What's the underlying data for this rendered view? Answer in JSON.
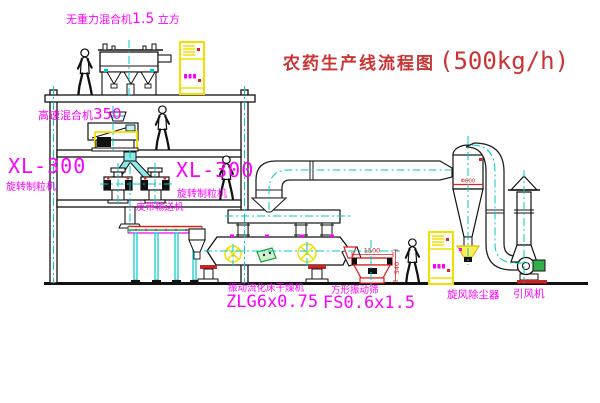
{
  "title": {
    "text": "农药生产线流程图",
    "capacity": "(500kg/h)"
  },
  "labels": {
    "gravity_mixer": {
      "name": "无重力混合机",
      "value": "1.5",
      "unit": "立方"
    },
    "high_speed_mixer": {
      "name": "高速混合机",
      "value": "350"
    },
    "granulator_left": {
      "model": "XL-300",
      "name": "旋转制粒机"
    },
    "granulator_right": {
      "model": "XL-300",
      "name": "旋转制粒机"
    },
    "belt_conveyor": "皮带输送机",
    "fluid_bed_dryer": {
      "name": "振动流化床干燥机",
      "model": "ZLG6x0.75"
    },
    "vibrating_screen": {
      "name": "方形振动筛",
      "model": "FS0.6x1.5"
    },
    "cyclone": "旋风除尘器",
    "induced_draft_fan": "引风机"
  },
  "dimensions": {
    "screen_length": "1500",
    "screen_height": "540",
    "cyclone_note": "Φ600"
  },
  "colors": {
    "label": "#ff00ff",
    "title": "#cc3333",
    "line": "#1a1a1a",
    "centerline": "#00c8c8",
    "highlight": "#f0e000",
    "accent_red": "#dd2222",
    "accent_green": "#1fa33c"
  }
}
